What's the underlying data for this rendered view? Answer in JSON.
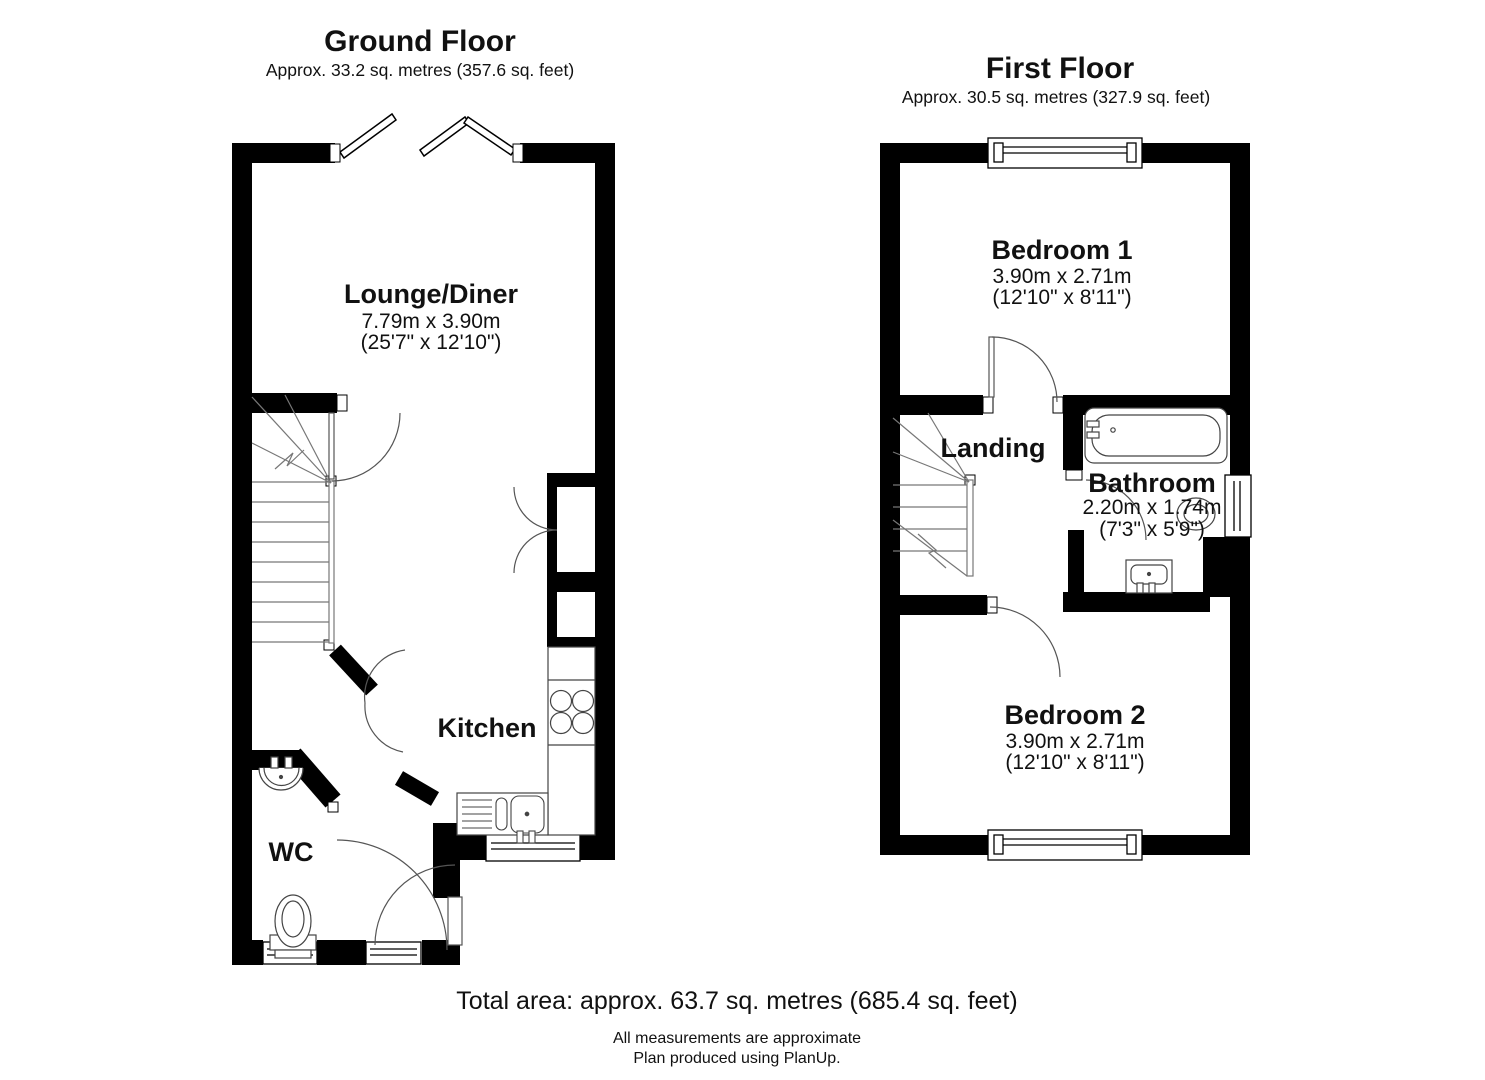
{
  "ground_floor": {
    "title": "Ground Floor",
    "area": "Approx. 33.2 sq. metres (357.6 sq. feet)",
    "rooms": {
      "lounge": {
        "name": "Lounge/Diner",
        "dims_metric": "7.79m x 3.90m",
        "dims_imperial": "(25'7\" x 12'10\")"
      },
      "kitchen": {
        "name": "Kitchen"
      },
      "wc": {
        "name": "WC"
      }
    }
  },
  "first_floor": {
    "title": "First Floor",
    "area": "Approx. 30.5 sq. metres (327.9 sq. feet)",
    "rooms": {
      "bedroom1": {
        "name": "Bedroom 1",
        "dims_metric": "3.90m x 2.71m",
        "dims_imperial": "(12'10\" x 8'11\")"
      },
      "landing": {
        "name": "Landing"
      },
      "bathroom": {
        "name": "Bathroom",
        "dims_metric": "2.20m x 1.74m",
        "dims_imperial": "(7'3\" x 5'9\")"
      },
      "bedroom2": {
        "name": "Bedroom 2",
        "dims_metric": "3.90m x 2.71m",
        "dims_imperial": "(12'10\" x 8'11\")"
      }
    }
  },
  "footer": {
    "total_area": "Total area: approx. 63.7 sq. metres (685.4 sq. feet)",
    "note_measurements": "All measurements are approximate",
    "note_producer": "Plan produced using PlanUp."
  },
  "colors": {
    "wall": "#000000",
    "fixture_line": "#444444",
    "stair_line": "#777777",
    "background": "#ffffff"
  }
}
